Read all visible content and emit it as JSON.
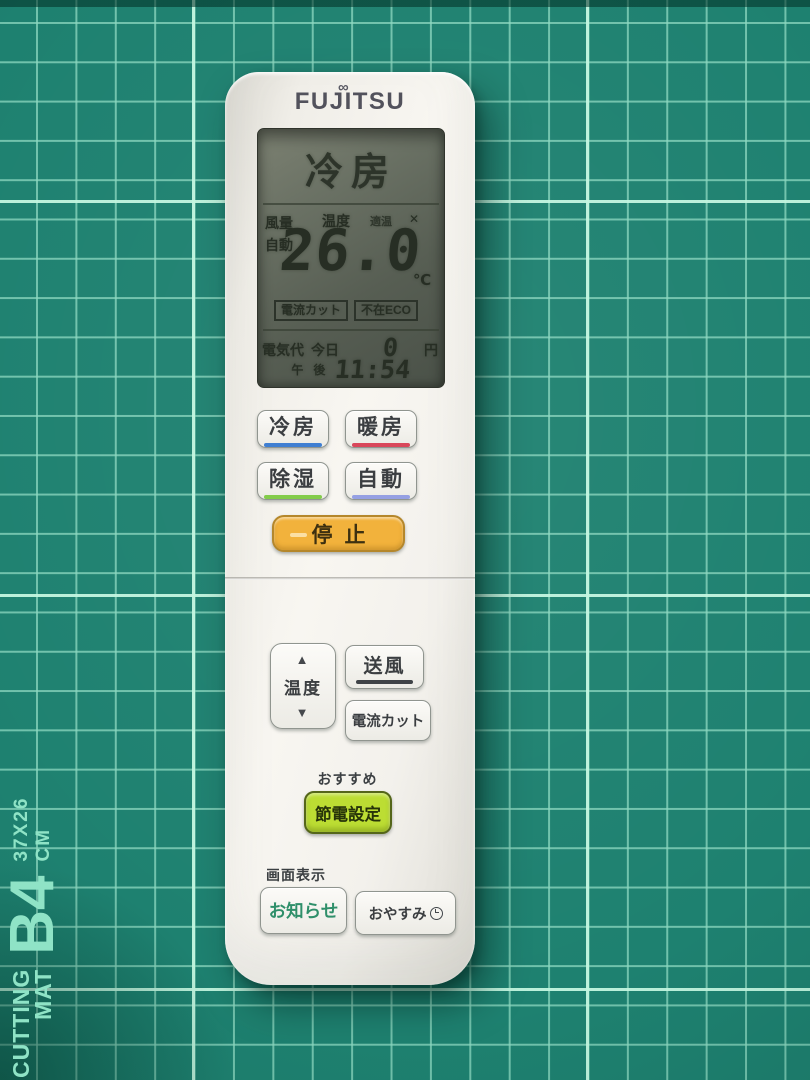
{
  "mat": {
    "label": {
      "line1": "CUTTING",
      "line2": "MAT",
      "size": "B4",
      "dimensions": "37X26 CM"
    },
    "colors": {
      "base": "#1E8170",
      "minor_grid": "#8CD8C0",
      "major_grid": "#C3F6E0",
      "label_text": "#8FE3C6"
    }
  },
  "remote": {
    "brand": "FUJITSU",
    "display": {
      "mode": "冷房",
      "fan_label": "風量",
      "fan_value": "自動",
      "temp_label": "温度",
      "temp_status": "適温",
      "temp_status_mark": "✕",
      "temperature": "26.0",
      "unit": "℃",
      "badges": [
        "電流カット",
        "不在ECO"
      ],
      "cost_label": "電気代",
      "cost_period": "今日",
      "cost_value": "0",
      "cost_unit": "円",
      "ampm_first": "午",
      "ampm_second": "後",
      "time": "11:54"
    },
    "buttons": {
      "cool": "冷房",
      "heat": "暖房",
      "dry": "除湿",
      "auto": "自動",
      "stop": "停止",
      "temp": "温度",
      "fan": "送風",
      "current_cut": "電流カット",
      "eco": "節電設定",
      "notice": "お知らせ",
      "sleep": "おやすみ"
    },
    "labels": {
      "eco_header": "おすすめ",
      "display_header": "画面表示"
    },
    "colors": {
      "cool_underline": "#3F7FD2",
      "heat_underline": "#D9475A",
      "dry_underline": "#83CC4A",
      "auto_underline": "#95A0E3",
      "fan_underline": "#3F4347",
      "stop_button": "#F2B23C",
      "eco_button": "#BCDD33",
      "notice_text": "#2F8F6A"
    },
    "icons": {
      "infinity": "∞",
      "up_arrow": "▲",
      "down_arrow": "▼"
    }
  }
}
